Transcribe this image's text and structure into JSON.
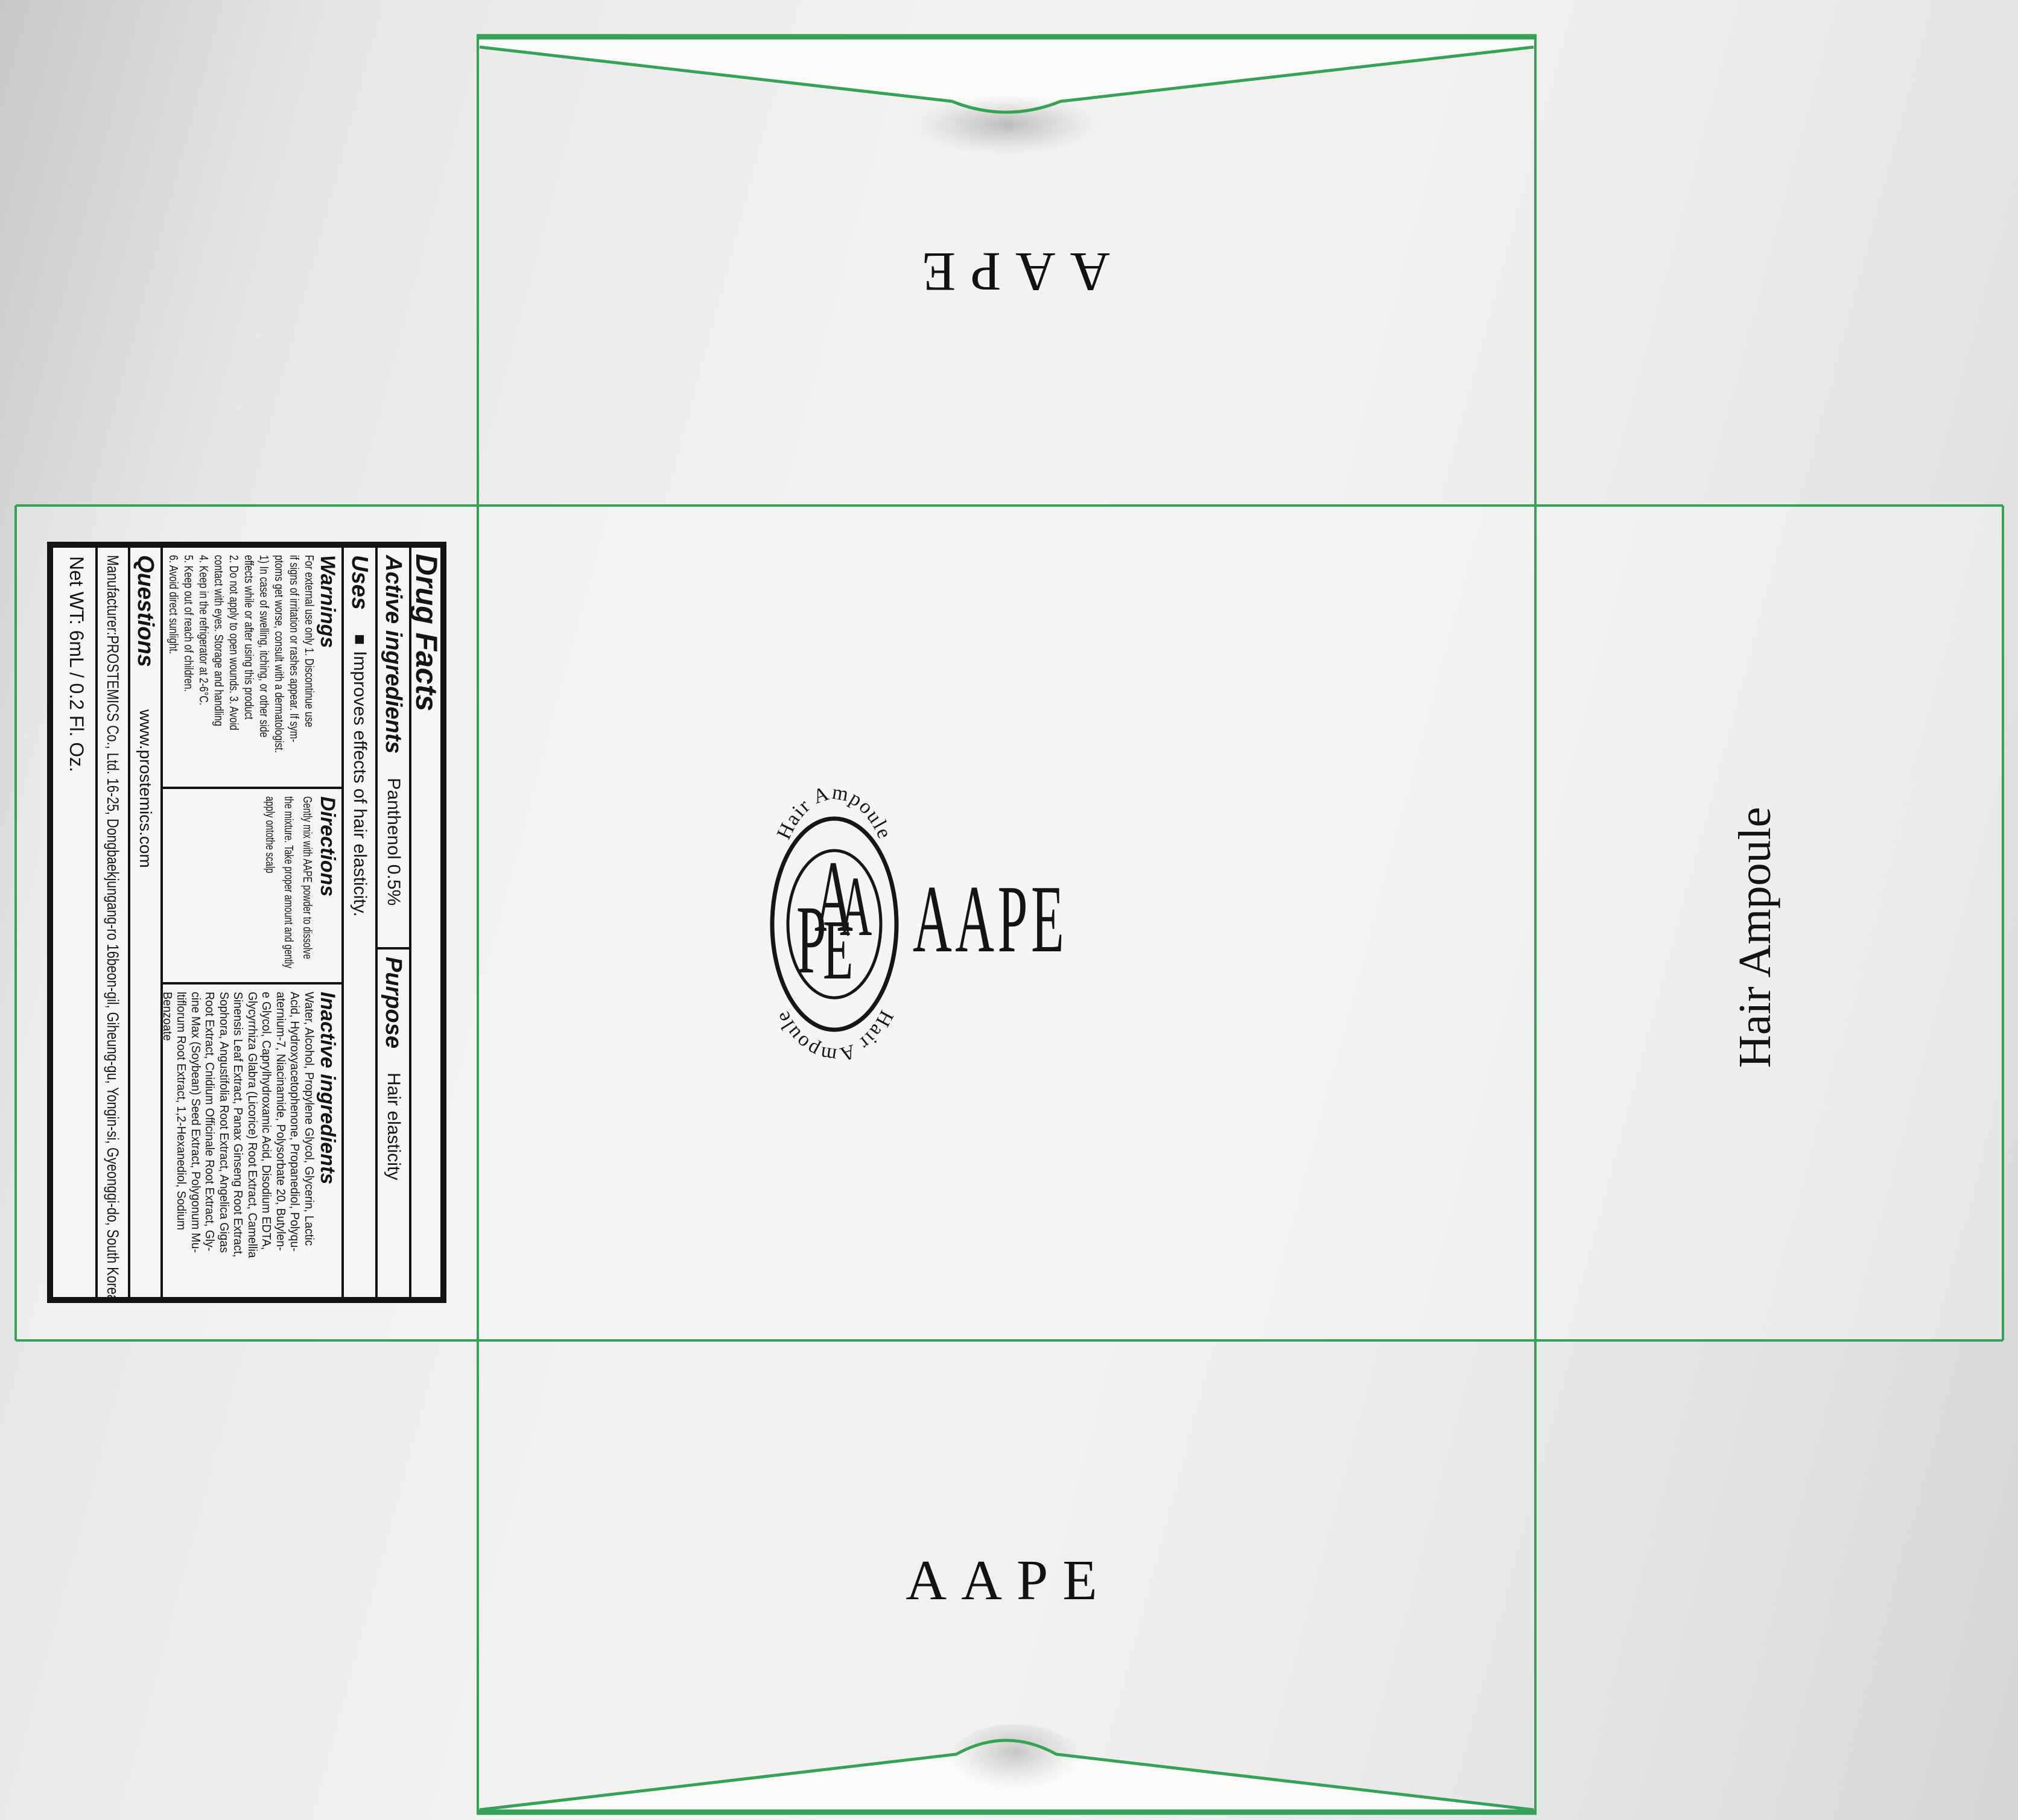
{
  "colors": {
    "dieline_green": "#36a257",
    "flap_white": "#fbfbfa",
    "ink": "#141414",
    "label_background": "#f6f6f4",
    "background_gray": "#e7e8e8"
  },
  "flaps": {
    "top_wordmark": "AAPE",
    "bottom_wordmark": "AAPE"
  },
  "side_panel": {
    "text": "Hair Ampoule"
  },
  "logo": {
    "arc_top": "Hair Ampoule",
    "arc_bottom": "Hair Ampoule",
    "monogram_a1": "A",
    "monogram_a2": "A",
    "monogram_p": "P",
    "monogram_e": "E",
    "wordmark": "AAPE"
  },
  "drug_facts": {
    "title": "Drug Facts",
    "active_label": "Active ingredients",
    "active_value": "Panthenol 0.5%",
    "purpose_label": "Purpose",
    "purpose_value": "Hair elasticity",
    "uses_label": "Uses",
    "uses_bullet": "■",
    "uses_value": "Improves effects of hair elasticity.",
    "warnings_label": "Warnings",
    "warnings_lines": [
      "For external use only  1. Discontinue use",
      "if signs of irritation or rashes appear. If sym-",
      "ptoms get worse, consult with a dermatologist.",
      "1) In case of swelling, itching, or other side",
      "effects while or after using this product",
      "2. Do not apply to open wounds.  3. Avoid",
      "contact with eyes. Storage and handling",
      "4. Keep in the refrigerator at 2-6°C.",
      "5. Keep out of reach of children.",
      "6. Avoid direct sunlight."
    ],
    "directions_label": "Directions",
    "directions_lines": [
      "Gently mix with AAPE powder to dissolve",
      "the mixture. Take proper amount and gently",
      "apply ontothe scalp"
    ],
    "inactive_label": "Inactive ingredients",
    "inactive_lines": [
      "Water, Alcohol, Propylene Glycol, Glycerin, Lactic",
      "Acid, Hydroxyacetophenone, Propanediol, Polyqu-",
      "aternium-7, Niacinamide, Polysorbate 20, Butylen-",
      "e Glycol, Caprylhydroxamic Acid, Disodium EDTA,",
      "Glycyrrhiza Glabra (Licorice) Root Extract, Camellia",
      "Sinensis Leaf Extract, Panax Ginseng Root Extract,",
      "Sophora, Angustifolia Root Extract, Angelica Gigas",
      "Root Extract, Cnidium Officinale Root Extract, Gly-",
      "cine Max (Soybean) Seed Extract, Polygonum Mu-",
      "ltiflorum Root Extract, 1,2-Hexanediol, Sodium",
      "Benzoate"
    ],
    "questions_label": "Questions",
    "questions_value": "www.prostemics.com",
    "manufacturer": "Manufacturer:PROSTEMICS Co., Ltd.  16-25, Dongbaekjungang-ro 16beon-gil, Giheung-gu, Yongin-si, Gyeonggi-do, South Korea",
    "net_weight": "Net WT: 6mL / 0.2 Fl. Oz."
  }
}
